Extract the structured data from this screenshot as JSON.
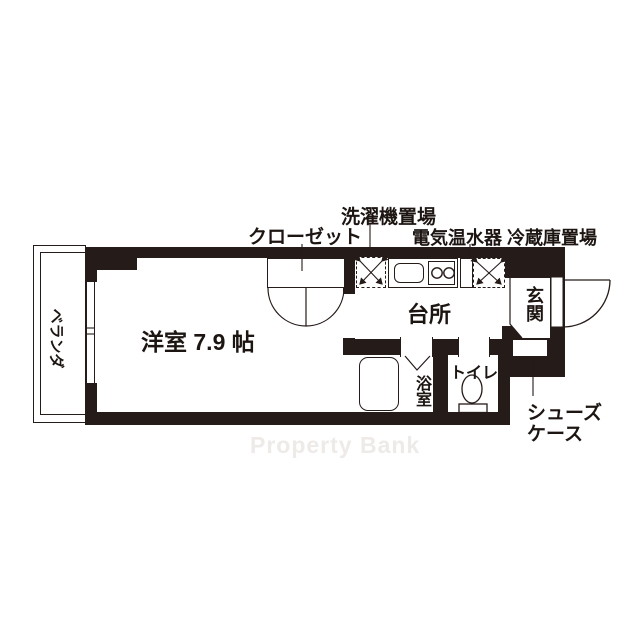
{
  "plan": {
    "rooms": {
      "main_room": "洋室 7.9 帖",
      "kitchen": "台所",
      "entrance": "玄関",
      "bathroom": "浴室",
      "toilet": "トイレ",
      "veranda": "ベランダ",
      "closet": "クローゼット"
    },
    "annotations": {
      "washer_space": "洗濯機置場",
      "heater_fridge_space": "電気温水器 冷蔵庫置場",
      "shoe_case_line1": "シューズ",
      "shoe_case_line2": "ケース"
    },
    "watermark": "Property Bank",
    "colors": {
      "wall": "#251b18",
      "line": "#251b18",
      "watermark_text": "#edeae8",
      "background": "#ffffff"
    }
  }
}
